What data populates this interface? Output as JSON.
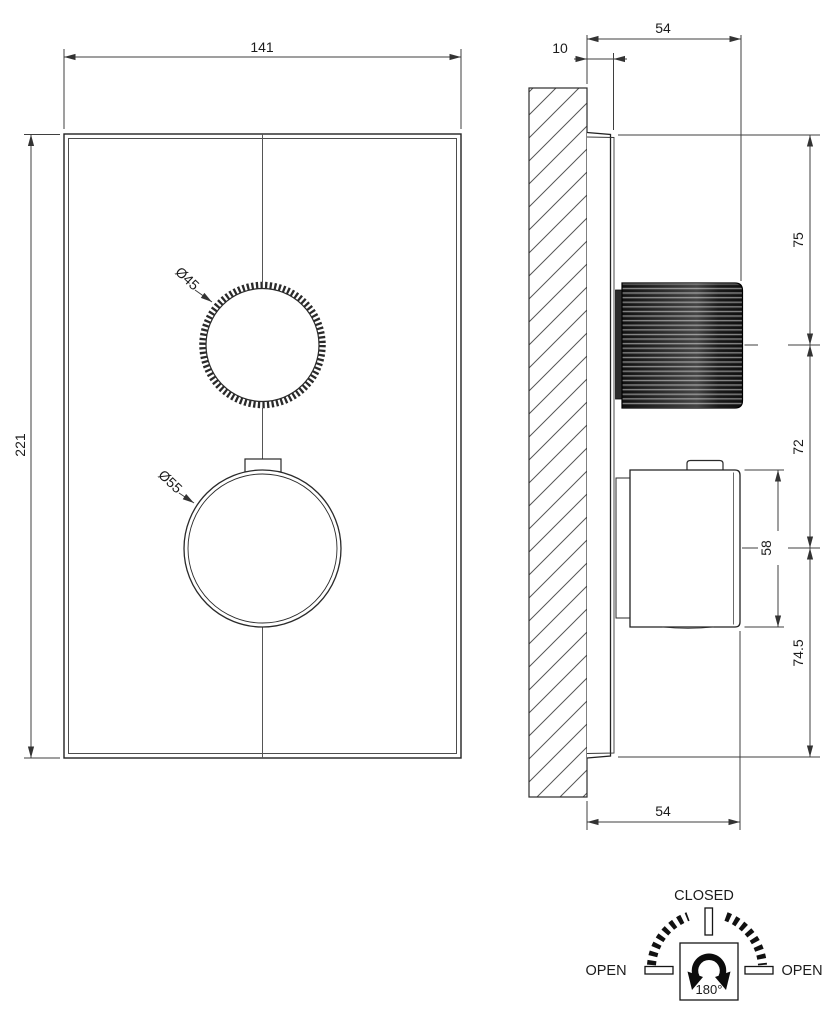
{
  "drawing": {
    "front_view": {
      "width_dim": "141",
      "height_dim": "221",
      "top_knob_diameter": "Ø45",
      "bottom_knob_diameter": "Ø55"
    },
    "side_view": {
      "plate_thickness_dim": "10",
      "projection_top_dim": "54",
      "top_knob_center_dim": "75",
      "knob_spacing_dim": "72",
      "bottom_knob_body_dim": "58",
      "bottom_center_dim": "74.5",
      "projection_bottom_dim": "54"
    },
    "rotation_diagram": {
      "closed_label": "CLOSED",
      "open_left_label": "OPEN",
      "open_right_label": "OPEN",
      "angle_label": "180°"
    },
    "colors": {
      "object_line": "#222222",
      "dim_line": "#3f3f3f",
      "knob_dark": "#141414",
      "background": "#ffffff"
    }
  }
}
